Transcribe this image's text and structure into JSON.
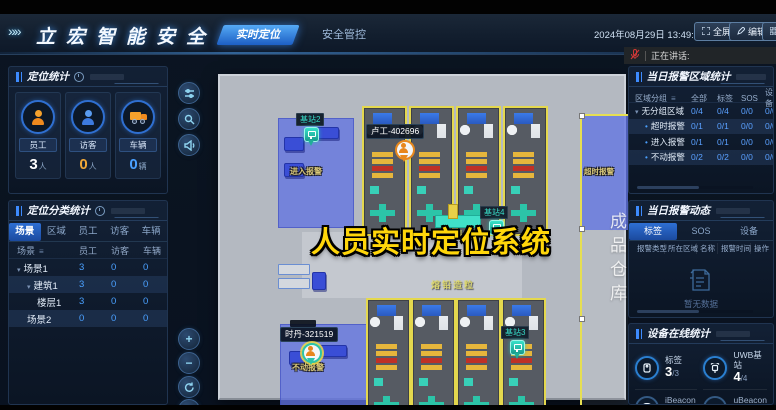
{
  "header": {
    "logo": "立宏智能安全",
    "tabs": [
      {
        "label": "实时定位"
      },
      {
        "label": "安全管控"
      }
    ],
    "datetime": "2024年08月29日 13:49:34",
    "fullscreen_label": "全屏",
    "edit_label": "编辑",
    "voice_label": "正在讲话:"
  },
  "left": {
    "stats": {
      "title": "定位统计",
      "cards": [
        {
          "label": "员工",
          "value": "3",
          "unit": "人"
        },
        {
          "label": "访客",
          "value": "0",
          "unit": "人"
        },
        {
          "label": "车辆",
          "value": "0",
          "unit": "辆"
        }
      ]
    },
    "classify": {
      "title": "定位分类统计",
      "tabs": [
        {
          "label": "场景"
        },
        {
          "label": "区域"
        },
        {
          "label": "员工"
        },
        {
          "label": "访客"
        },
        {
          "label": "车辆"
        }
      ],
      "columns": {
        "c0": "场景",
        "c1": "员工",
        "c2": "访客",
        "c3": "车辆"
      },
      "rows": [
        {
          "name": "场景1",
          "v1": "3",
          "v2": "0",
          "v3": "0"
        },
        {
          "name": "建筑1",
          "v1": "3",
          "v2": "0",
          "v3": "0"
        },
        {
          "name": "楼层1",
          "v1": "3",
          "v2": "0",
          "v3": "0"
        },
        {
          "name": "场景2",
          "v1": "0",
          "v2": "0",
          "v3": "0"
        }
      ]
    }
  },
  "map": {
    "caption": "人员实时定位系统",
    "zone_entry": "进入报警",
    "zone_idle": "不动报警",
    "zone_timeout": "超时报警",
    "warehouse": "成品仓库",
    "floor_text_top": "熔铅制粒",
    "floor_text_bottom": "熔铅造粒",
    "person1": "卢工-402696",
    "person2": "时丹-321519",
    "station2": "基站2",
    "station3": "基站3",
    "station4": "基站4"
  },
  "right": {
    "alarm_area": {
      "title": "当日报警区域统计",
      "columns": {
        "c0": "区域分组",
        "c1": "全部",
        "c2": "标签",
        "c3": "SOS",
        "c4": "设备"
      },
      "rows": [
        {
          "name": "无分组区域",
          "v1": "0/4",
          "v2": "0/4",
          "v3": "0/0",
          "v4": "0/0"
        },
        {
          "name": "超时报警",
          "v1": "0/1",
          "v2": "0/1",
          "v3": "0/0",
          "v4": "0/0"
        },
        {
          "name": "进入报警",
          "v1": "0/1",
          "v2": "0/1",
          "v3": "0/0",
          "v4": "0/0"
        },
        {
          "name": "不动报警",
          "v1": "0/2",
          "v2": "0/2",
          "v3": "0/0",
          "v4": "0/0"
        }
      ]
    },
    "alarm_feed": {
      "title": "当日报警动态",
      "tabs": [
        {
          "label": "标签"
        },
        {
          "label": "SOS"
        },
        {
          "label": "设备"
        }
      ],
      "columns": {
        "c0": "报警类型",
        "c1": "所在区域",
        "c2": "名称",
        "c3": "报警时间",
        "c4": "操作"
      },
      "empty": "暂无数据"
    },
    "devices": {
      "title": "设备在线统计",
      "items": [
        {
          "label": "标签",
          "value": "3",
          "total": "/3"
        },
        {
          "label": "UWB基站",
          "value": "4",
          "total": "/4"
        },
        {
          "label": "iBeacon",
          "value": "0",
          "total": "/0"
        },
        {
          "label": "uBeacon",
          "value": "0",
          "total": "/0"
        }
      ]
    }
  }
}
